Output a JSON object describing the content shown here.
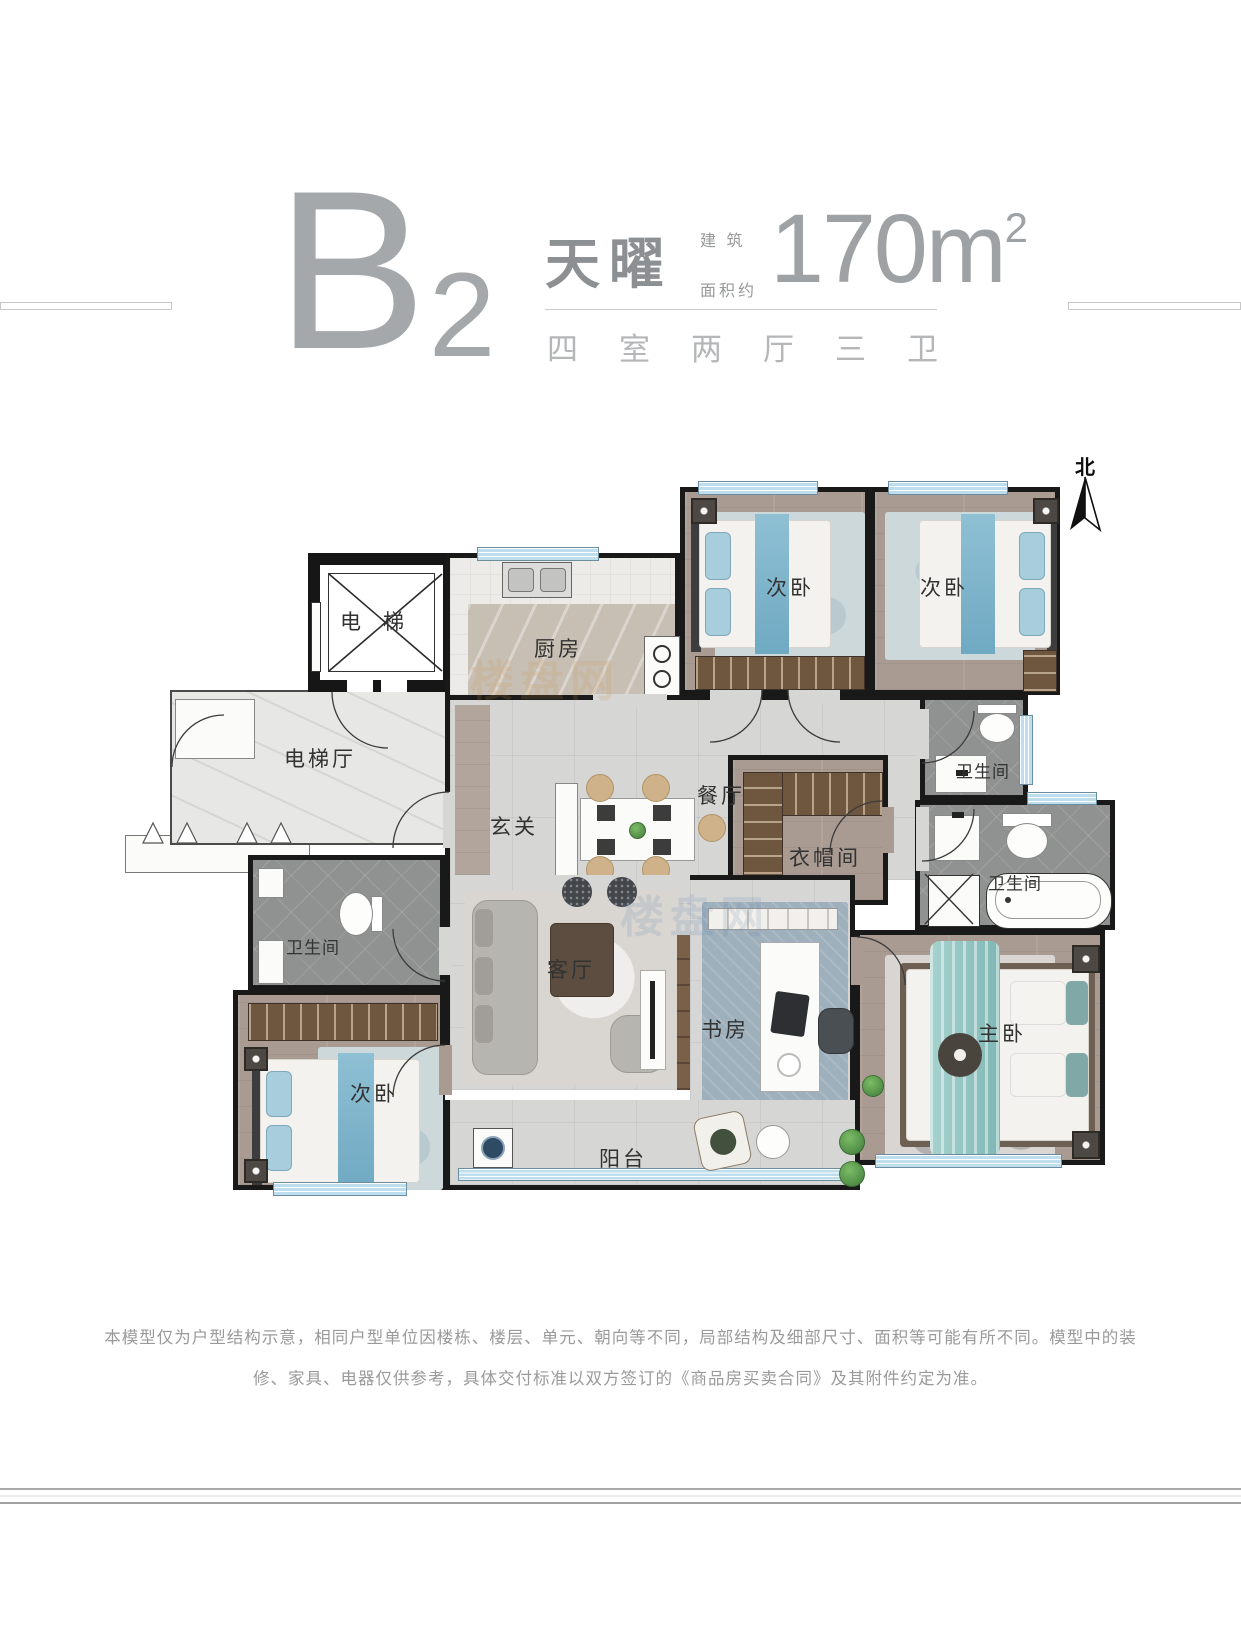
{
  "header": {
    "unit_letter": "B",
    "unit_number": "2",
    "project_name": "天曜",
    "area_label_line1": "建 筑",
    "area_label_line2": "面积约",
    "area_value": "170m",
    "area_sup": "2",
    "layout_summary": "四室两厅三卫"
  },
  "compass": {
    "label": "北"
  },
  "plan": {
    "rooms": {
      "elevator": "电梯",
      "elevator_hall": "电梯厅",
      "kitchen": "厨房",
      "bedroom_a": "次卧",
      "bedroom_b": "次卧",
      "bath_a": "卫生间",
      "dining": "餐厅",
      "foyer": "玄关",
      "cloakroom": "衣帽间",
      "bath_b": "卫生间",
      "bath_c": "卫生间",
      "living": "客厅",
      "study": "书房",
      "master": "主卧",
      "bedroom_c": "次卧",
      "balcony": "阳台"
    }
  },
  "watermark": {
    "text": "楼盘网"
  },
  "disclaimer": {
    "line1": "本模型仅为户型结构示意，相同户型单位因楼栋、楼层、单元、朝向等不同，局部结构及细部尺寸、面积等可能有所不同。模型中的装",
    "line2": "修、家具、电器仅供参考，具体交付标准以双方签订的《商品房买卖合同》及其附件约定为准。"
  },
  "colors": {
    "wall": "#191919",
    "window_blue": "#bfdeed",
    "wood_floor": "#a99b92",
    "tile_floor": "#d6d6d5",
    "bath_floor": "#909191",
    "closet_wood": "#6e563f",
    "accent_blue": "#8fc0d4",
    "accent_teal": "#85b8b5",
    "header_gray": "#9fa2a5",
    "label_dark": "#323232"
  }
}
